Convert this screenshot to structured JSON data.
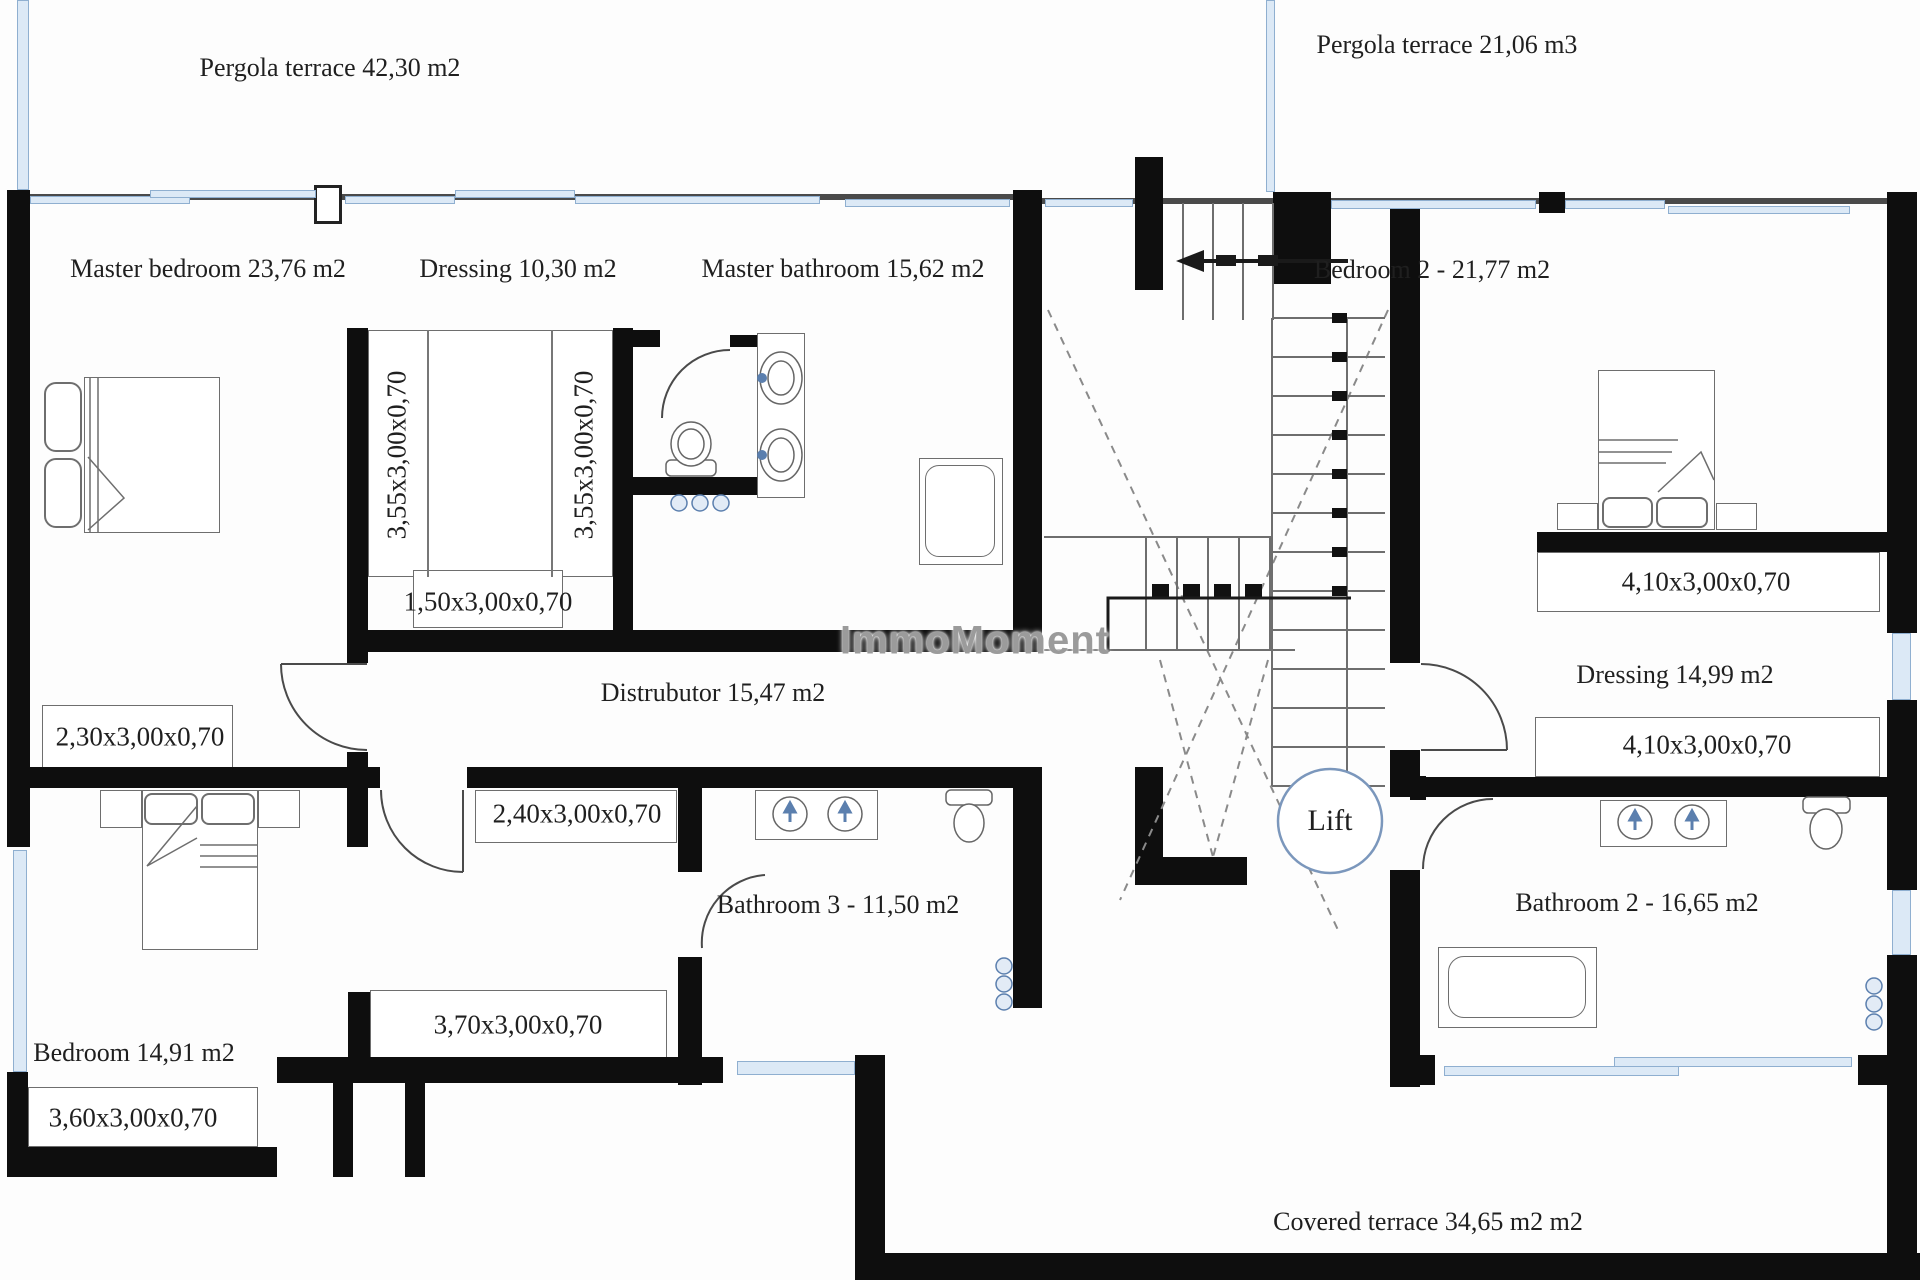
{
  "title": "First floor plan",
  "colors": {
    "wall": "#0e0e0e",
    "window_fill": "#dce9f6",
    "window_border": "#8fafd0",
    "fixture_accent": "#5b7fae",
    "lift_ring": "#7b97bc",
    "linework": "#666666",
    "watermark_gray": "#9b9b9b",
    "text": "#1f1f1f"
  },
  "labels": {
    "pergola_left": "Pergola terrace 42,30 m2",
    "pergola_right": "Pergola terrace 21,06 m3",
    "master_bedroom": "Master bedroom 23,76 m2",
    "dressing_1": "Dressing 10,30 m2",
    "master_bathroom": "Master bathroom 15,62 m2",
    "bedroom_2": "Bedroom 2 -  21,77 m2",
    "distributor": "Distrubutor 15,47 m2",
    "dressing_2": "Dressing 14,99 m2",
    "bathroom_3": "Bathroom 3 - 11,50 m2",
    "bathroom_2": "Bathroom 2 -  16,65 m2",
    "bedroom_3": "Bedroom 14,91 m2",
    "covered_terrace": "Covered terrace 34,65 m2 m2",
    "lift": "Lift",
    "watermark": "ImmoMoment"
  },
  "dimensions": {
    "wardrobe_left": "3,55x3,00x0,70",
    "wardrobe_right": "3,55x3,00x0,70",
    "dresser_150": "1,50x3,00x0,70",
    "closet_410_top": "4,10x3,00x0,70",
    "closet_410_bottom": "4,10x3,00x0,70",
    "closet_230": "2,30x3,00x0,70",
    "closet_240": "2,40x3,00x0,70",
    "closet_370": "3,70x3,00x0,70",
    "closet_360": "3,60x3,00x0,70"
  }
}
